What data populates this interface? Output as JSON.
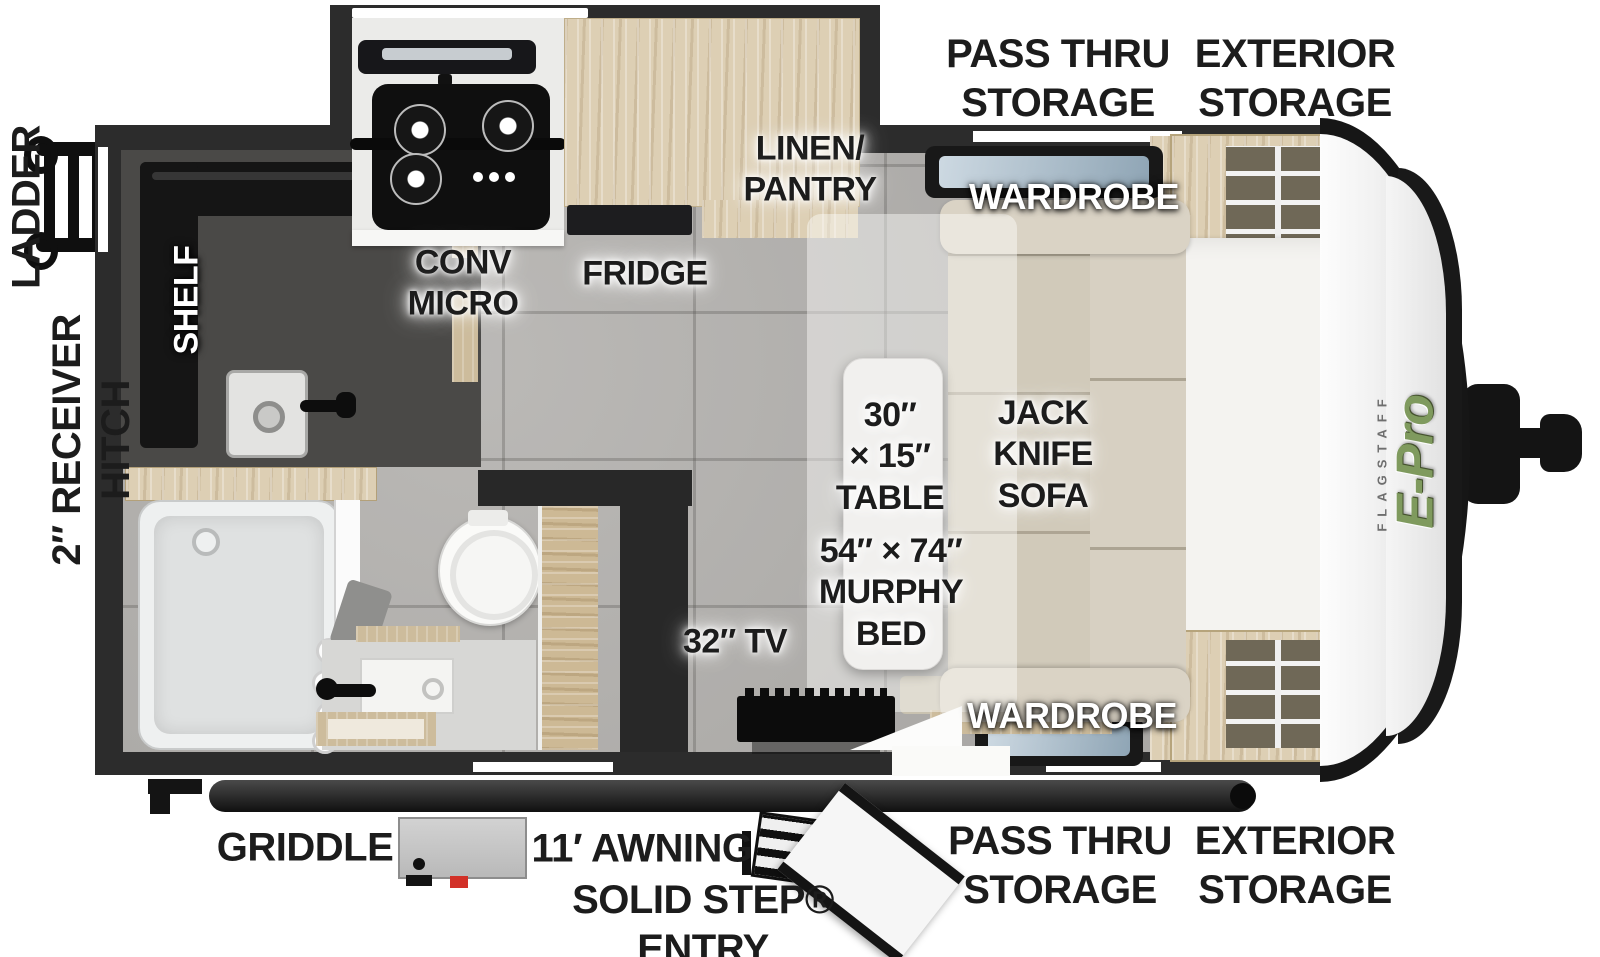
{
  "meta": {
    "title": "Flagstaff E-Pro Travel Trailer Floorplan"
  },
  "brand": {
    "flagstaff": "FLAGSTAFF",
    "model": "E-Pro"
  },
  "exterior": {
    "pass_thru_top": "PASS THRU\nSTORAGE",
    "exterior_top": "EXTERIOR\nSTORAGE",
    "ladder": "LADDER",
    "receiver_hitch": "2″ RECEIVER\nHITCH",
    "griddle": "GRIDDLE",
    "awning": "11′ AWNING",
    "solid_step": "SOLID STEP®\nENTRY",
    "pass_thru_bottom": "PASS THRU\nSTORAGE",
    "exterior_bottom": "EXTERIOR\nSTORAGE"
  },
  "interior": {
    "shelf": "SHELF",
    "conv_micro": "CONV\nMICRO",
    "fridge": "FRIDGE",
    "linen_pantry": "LINEN/\nPANTRY",
    "wardrobe_top": "WARDROBE",
    "wardrobe_bottom": "WARDROBE",
    "table": "30″\n× 15″\nTABLE",
    "jack_knife_sofa": "JACK\nKNIFE\nSOFA",
    "murphy_bed": "54″ × 74″\nMURPHY\nBED",
    "tv": "32″ TV"
  },
  "colors": {
    "wall": "#2c2c2c",
    "floor": "#b3b1ae",
    "wood": "#ddcfb4",
    "sofa": "#cfc8b7",
    "label_dark": "#1c1c1c",
    "label_light": "#ffffff",
    "logo_green": "#7f9a5e",
    "griddle_red": "#d23128"
  }
}
